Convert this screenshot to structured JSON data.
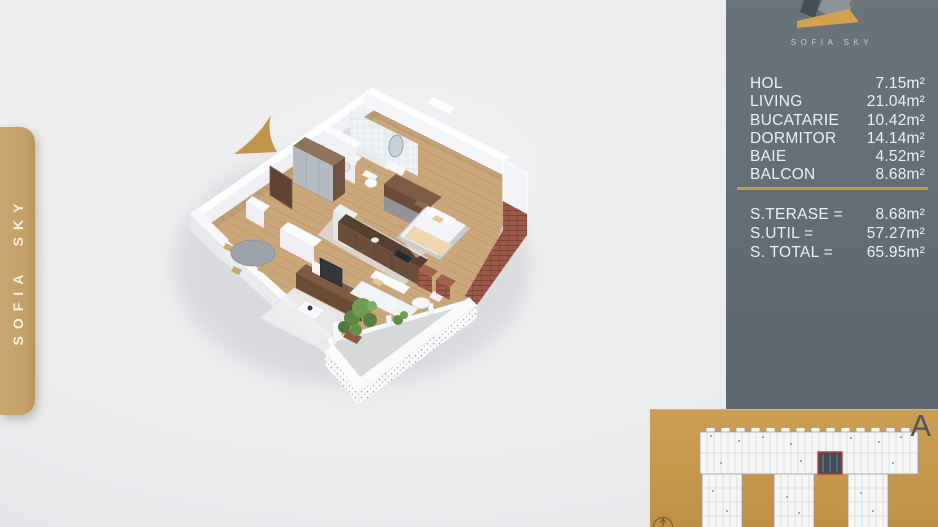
{
  "brand": {
    "name": "SOFIA SKY",
    "side_tab_label": "SOFIA SKY",
    "logo_caption": "SOFIA SKY"
  },
  "panel": {
    "rooms": [
      {
        "name": "HOL",
        "area": "7.15m²"
      },
      {
        "name": "LIVING",
        "area": "21.04m²"
      },
      {
        "name": "BUCATARIE",
        "area": "10.42m²"
      },
      {
        "name": "DORMITOR",
        "area": "14.14m²"
      },
      {
        "name": "BAIE",
        "area": "4.52m²"
      },
      {
        "name": "BALCON",
        "area": "8.68m²"
      }
    ],
    "totals": [
      {
        "name": "S.TERASE =",
        "area": "8.68m²"
      },
      {
        "name": "S.UTIL =",
        "area": "57.27m²"
      },
      {
        "name": "S. TOTAL =",
        "area": "65.95m²"
      }
    ]
  },
  "minimap": {
    "building_label": "A"
  },
  "icons": [
    "north-arrow-icon",
    "compass-icon",
    "sofia-sky-logo"
  ],
  "colors": {
    "accent_gold": "#C7984A",
    "panel_slate": "#626C74",
    "tab_gold": "#C2A067",
    "minimap_gold": "#C6974B",
    "unit_highlight_red": "#C03A3A",
    "background": "#EAEBED"
  }
}
